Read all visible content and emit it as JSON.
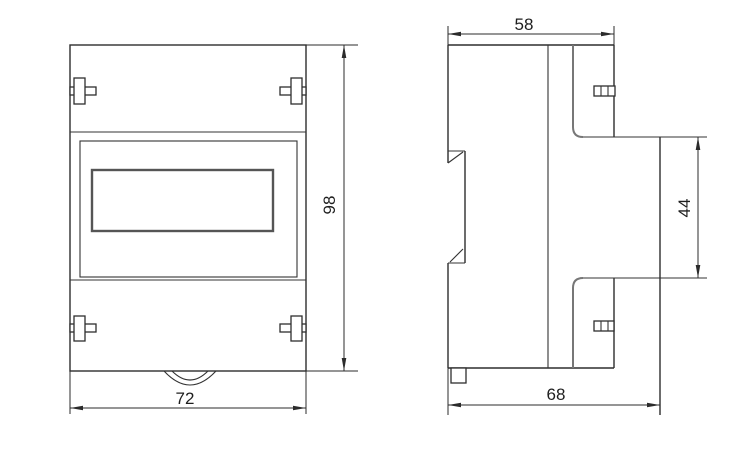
{
  "colors": {
    "background": "#ffffff",
    "line": "#333333",
    "dimension_text": "#1e1e1e"
  },
  "dimensions": {
    "front_width": "72",
    "front_height": "98",
    "side_top_width": "58",
    "side_panel_height": "44",
    "side_bottom_width": "68"
  }
}
